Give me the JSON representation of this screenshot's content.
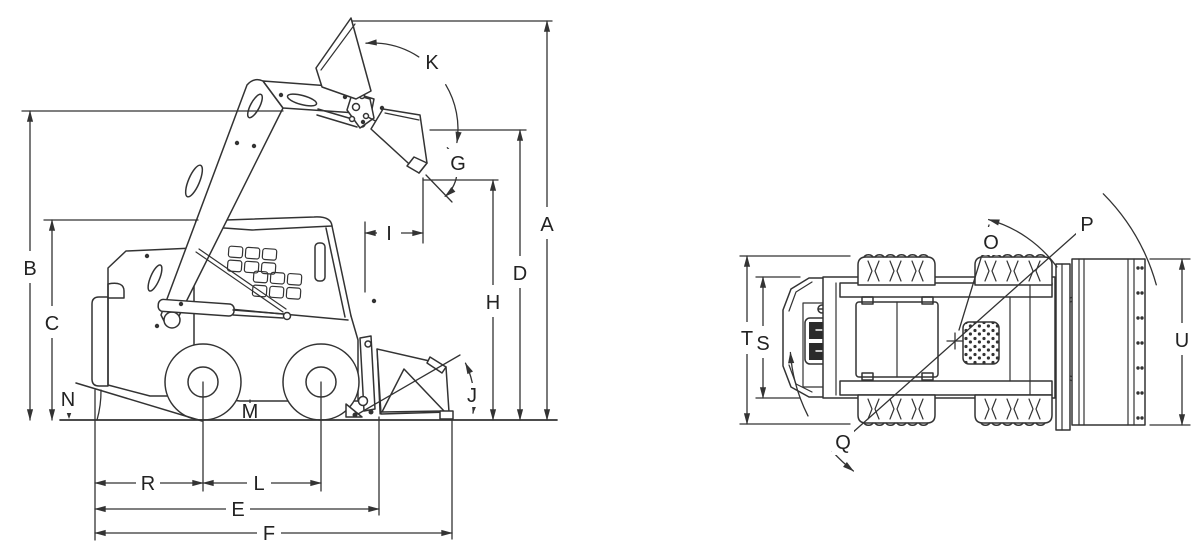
{
  "diagram": {
    "subject": "skid-steer-loader-dimension-drawing",
    "views": [
      "side-view",
      "top-view"
    ],
    "background": "#ffffff",
    "line_color": "#333333"
  },
  "labels": {
    "A": "A",
    "B": "B",
    "C": "C",
    "D": "D",
    "E": "E",
    "F": "F",
    "G": "G",
    "H": "H",
    "I": "I",
    "J": "J",
    "K": "K",
    "L": "L",
    "M": "M",
    "N": "N",
    "O": "O",
    "P": "P",
    "Q": "Q",
    "R": "R",
    "S": "S",
    "T": "T",
    "U": "U"
  }
}
